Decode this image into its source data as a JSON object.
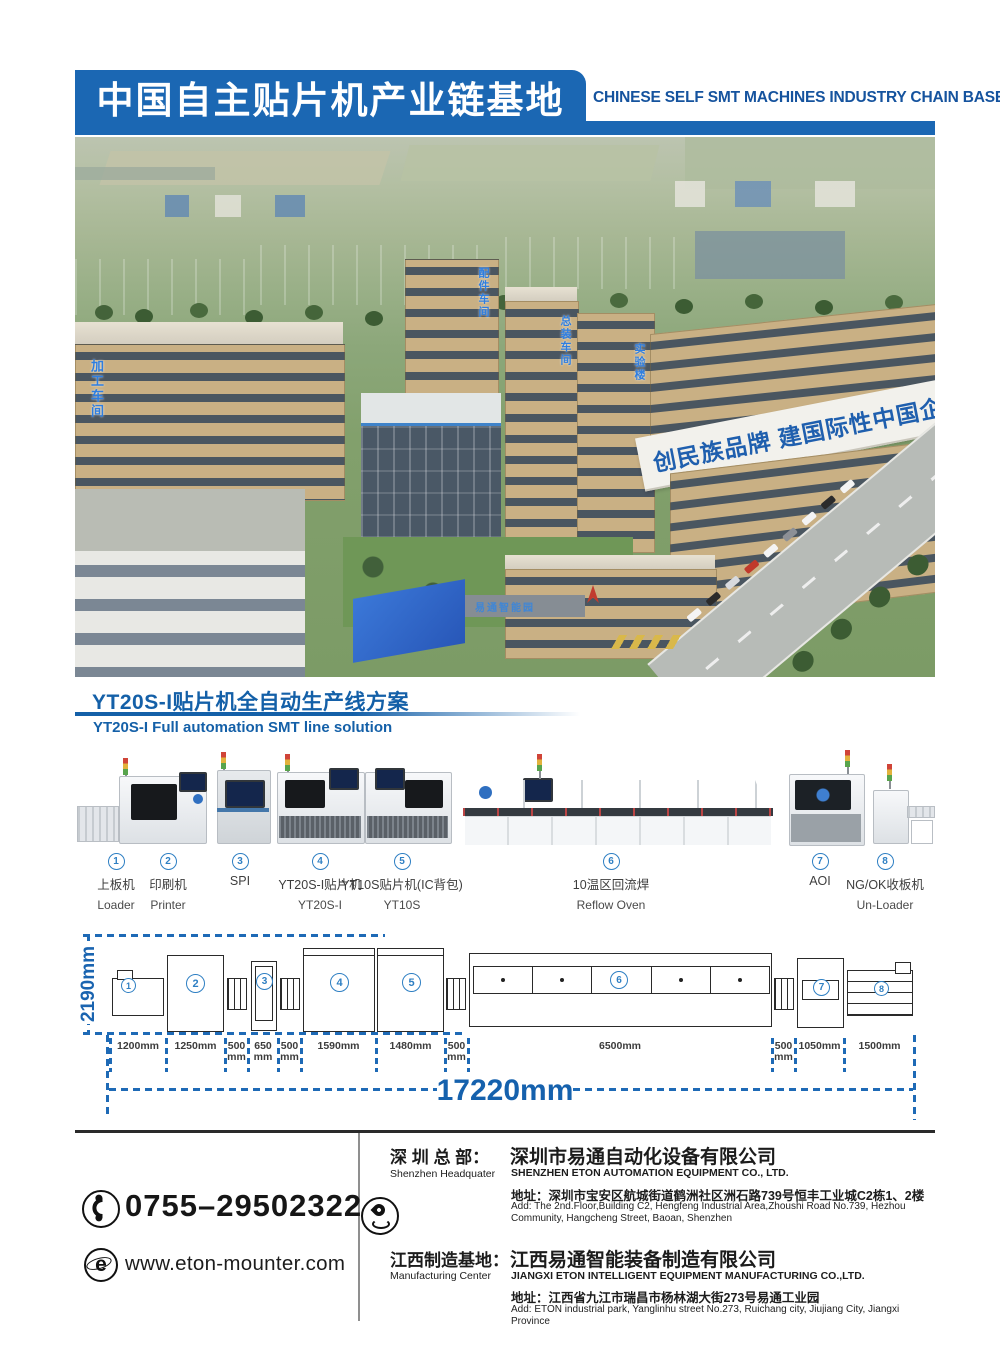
{
  "header": {
    "title_cn": "中国自主贴片机产业链基地",
    "title_en": "CHINESE SELF SMT MACHINES INDUSTRY CHAIN BASE"
  },
  "photo": {
    "slogan": "创民族品牌 建国际性中国企业",
    "label_process_building": "加工车间",
    "label_parts_building": "配件车间",
    "label_assembly_building": "总装车间",
    "label_lab_building": "实验楼",
    "gate_sign": "易通智能园"
  },
  "section": {
    "title_cn": "YT20S-I贴片机全自动生产线方案",
    "title_en": "YT20S-I Full automation SMT line solution"
  },
  "stations": [
    {
      "no": "1",
      "cn": "上板机",
      "en": "Loader"
    },
    {
      "no": "2",
      "cn": "印刷机",
      "en": "Printer"
    },
    {
      "no": "3",
      "cn": "SPI",
      "en": ""
    },
    {
      "no": "4",
      "cn": "YT20S-I贴片机",
      "en": "YT20S-I"
    },
    {
      "no": "5",
      "cn": "YT10S贴片机(IC背包)",
      "en": "YT10S"
    },
    {
      "no": "6",
      "cn": "10温区回流焊",
      "en": "Reflow Oven"
    },
    {
      "no": "7",
      "cn": "AOI",
      "en": ""
    },
    {
      "no": "8",
      "cn": "NG/OK收板机",
      "en": "Un-Loader"
    }
  ],
  "diagram": {
    "height_label": "2190mm",
    "total_label": "17220mm",
    "segments": [
      {
        "l1": "1200mm",
        "l2": ""
      },
      {
        "l1": "1250mm",
        "l2": ""
      },
      {
        "l1": "500",
        "l2": "mm"
      },
      {
        "l1": "650",
        "l2": "mm"
      },
      {
        "l1": "500",
        "l2": "mm"
      },
      {
        "l1": "1590mm",
        "l2": ""
      },
      {
        "l1": "1480mm",
        "l2": ""
      },
      {
        "l1": "500",
        "l2": "mm"
      },
      {
        "l1": "6500mm",
        "l2": ""
      },
      {
        "l1": "500",
        "l2": "mm"
      },
      {
        "l1": "1050mm",
        "l2": ""
      },
      {
        "l1": "1500mm",
        "l2": ""
      }
    ]
  },
  "contact": {
    "phone": "0755–29502322",
    "website": "www.eton-mounter.com"
  },
  "offices": [
    {
      "label_cn": "深 圳 总 部：",
      "label_en": "Shenzhen Headquater",
      "company_cn": "深圳市易通自动化设备有限公司",
      "company_en": "SHENZHEN ETON AUTOMATION EQUIPMENT CO., LTD.",
      "address_cn": "地址：深圳市宝安区航城街道鹤洲社区洲石路739号恒丰工业城C2栋1、2楼",
      "address_en": "Add: The 2nd.Floor,Building C2, Hengfeng Industrial Area,Zhoushi Road No.739, Hezhou Community, Hangcheng Street, Baoan, Shenzhen"
    },
    {
      "label_cn": "江西制造基地：",
      "label_en": "Manufacturing Center",
      "company_cn": "江西易通智能装备制造有限公司",
      "company_en": "JIANGXI ETON INTELLIGENT EQUIPMENT MANUFACTURING CO.,LTD.",
      "address_cn": "地址：江西省九江市瑞昌市杨林湖大街273号易通工业园",
      "address_en": "Add: ETON industrial park, Yanglinhu street No.273, Ruichang city, Jiujiang City, Jiangxi Province"
    }
  ]
}
